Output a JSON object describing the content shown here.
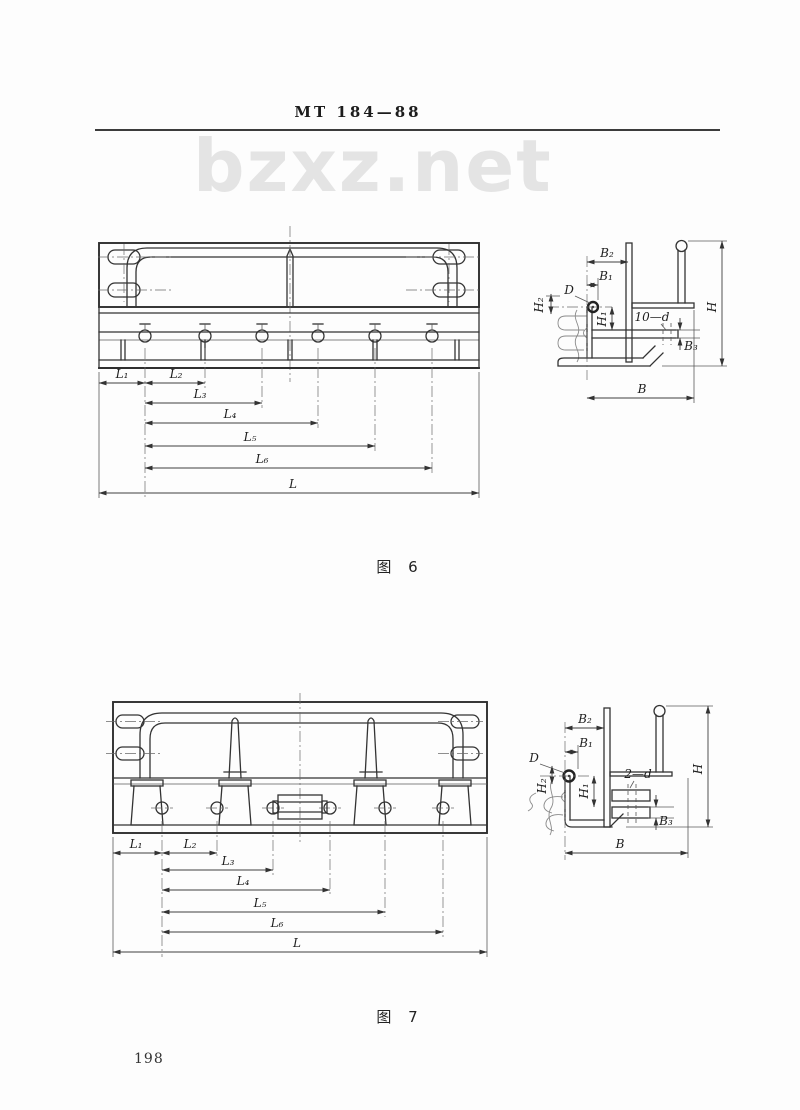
{
  "page": {
    "title": "MT 184—88",
    "watermark": "bzxz.net",
    "page_number": "198"
  },
  "figure6": {
    "caption": "图 6",
    "dims": {
      "l1": "L₁",
      "l2": "L₂",
      "l3": "L₃",
      "l4": "L₄",
      "l5": "L₅",
      "l6": "L₆",
      "l": "L"
    },
    "section": {
      "b2": "B₂",
      "b1": "B₁",
      "d": "D",
      "h2": "H₂",
      "h1": "H₁",
      "holes": "10—d",
      "b3": "B₃",
      "h": "H",
      "b": "B"
    }
  },
  "figure7": {
    "caption": "图 7",
    "dims": {
      "l1": "L₁",
      "l2": "L₂",
      "l3": "L₃",
      "l4": "L₄",
      "l5": "L₅",
      "l6": "L₆",
      "l": "L"
    },
    "section": {
      "b2": "B₂",
      "b1": "B₁",
      "d": "D",
      "h2": "H₂",
      "h1": "H₁",
      "holes": "2—d",
      "b3": "B₃",
      "h": "H",
      "b": "B"
    }
  }
}
